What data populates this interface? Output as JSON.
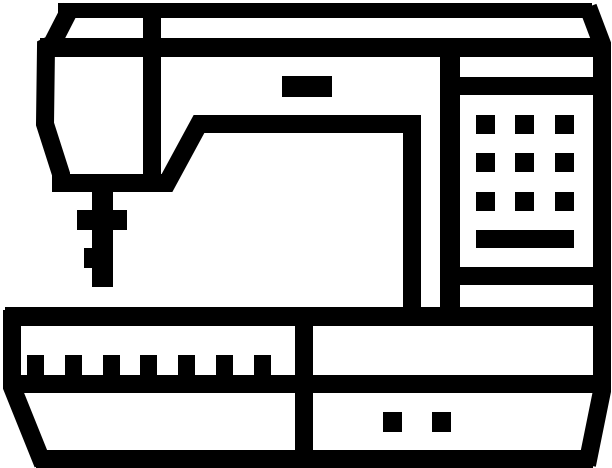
{
  "icon": {
    "name": "sewing-machine-icon",
    "title": "Sewing machine pictogram",
    "style": "thick black outline glyph on white background",
    "parts": [
      "machine-body-outline",
      "needle-arm",
      "needle-bar",
      "presser-foot-crossbar",
      "thread-guide-tab",
      "thread-slot",
      "control-panel",
      "panel-button-grid",
      "panel-display-bar",
      "machine-base",
      "feed-teeth-row",
      "drawer-section",
      "drawer-dots"
    ]
  },
  "canvas": {
    "width": 612,
    "height": 468
  },
  "colors": {
    "icon": "#000000",
    "background": "#ffffff"
  },
  "counts": {
    "panel_button_rows": 3,
    "panel_button_cols": 3,
    "panel_buttons_total": 9,
    "feed_teeth": 7,
    "drawer_dots": 2
  }
}
